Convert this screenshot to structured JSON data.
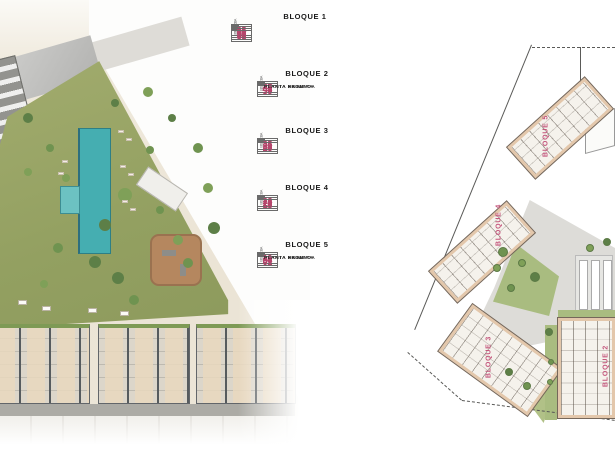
{
  "blocks": [
    {
      "title": "BLOQUE 1",
      "rows": [
        [
          "66",
          "63",
          "60",
          "57",
          "54",
          "51"
        ],
        [
          "65",
          "62",
          "59",
          "56",
          "53",
          "50"
        ],
        [
          "64",
          "61",
          "58",
          "55",
          "52",
          "49"
        ]
      ],
      "stair_labels": [
        "ESC.A",
        "ESC.B",
        "ESC.C"
      ],
      "sep_after_cols": [
        0,
        2,
        4
      ],
      "floor_labels": []
    },
    {
      "title": "BLOQUE 2",
      "rows": [
        [
          "48",
          "45",
          "42",
          "39"
        ],
        [
          "47",
          "44",
          "41",
          "38"
        ],
        [
          "46",
          "43",
          "40",
          "37"
        ]
      ],
      "stair_labels": [
        "ESC.A",
        "ESC.B"
      ],
      "sep_after_cols": [
        0,
        2
      ],
      "floor_labels": [
        "PLANTA SEGUNDA",
        "PLANTA PRIMERA",
        "PLANTA BAJA"
      ]
    },
    {
      "title": "BLOQUE 3",
      "rows": [
        [
          "36",
          "33",
          "30",
          "27"
        ],
        [
          "35",
          "32",
          "29",
          "26"
        ],
        [
          "34",
          "31",
          "28",
          "25"
        ]
      ],
      "stair_labels": [
        "ESC.A",
        "ESC.B"
      ],
      "sep_after_cols": [
        0,
        2
      ],
      "floor_labels": []
    },
    {
      "title": "BLOQUE 4",
      "rows": [
        [
          "24",
          "21",
          "18",
          "15"
        ],
        [
          "23",
          "20",
          "17",
          "14"
        ],
        [
          "22",
          "19",
          "16",
          "13"
        ]
      ],
      "stair_labels": [
        "ESC.A",
        "ESC.B"
      ],
      "sep_after_cols": [
        0,
        2
      ],
      "floor_labels": []
    },
    {
      "title": "BLOQUE 5",
      "rows": [
        [
          "12",
          "09",
          "06",
          "03"
        ],
        [
          "11",
          "08",
          "05",
          "02"
        ],
        [
          "10",
          "07",
          "04",
          "01"
        ]
      ],
      "stair_labels": [
        "ESC.A",
        "ESC.B"
      ],
      "sep_after_cols": [
        0,
        2
      ],
      "floor_labels": [
        "PLANTA SEGUNDA",
        "PLANTA PRIMERA",
        "PLANTA BAJA"
      ]
    }
  ],
  "site_plan": {
    "building_labels": [
      "BLOQUE 5",
      "BLOQUE 4",
      "BLOQUE 3",
      "BLOQUE 2"
    ]
  },
  "colors": {
    "unit_number": "#b5466c",
    "plan_label": "#c4567c",
    "table_border": "#6a6a6a",
    "block_title": "#1a1a1a",
    "pool": "#45aeb1",
    "lawn": "#9aa467",
    "terrace": "#e3c7ab",
    "playground": "#b5875f"
  }
}
